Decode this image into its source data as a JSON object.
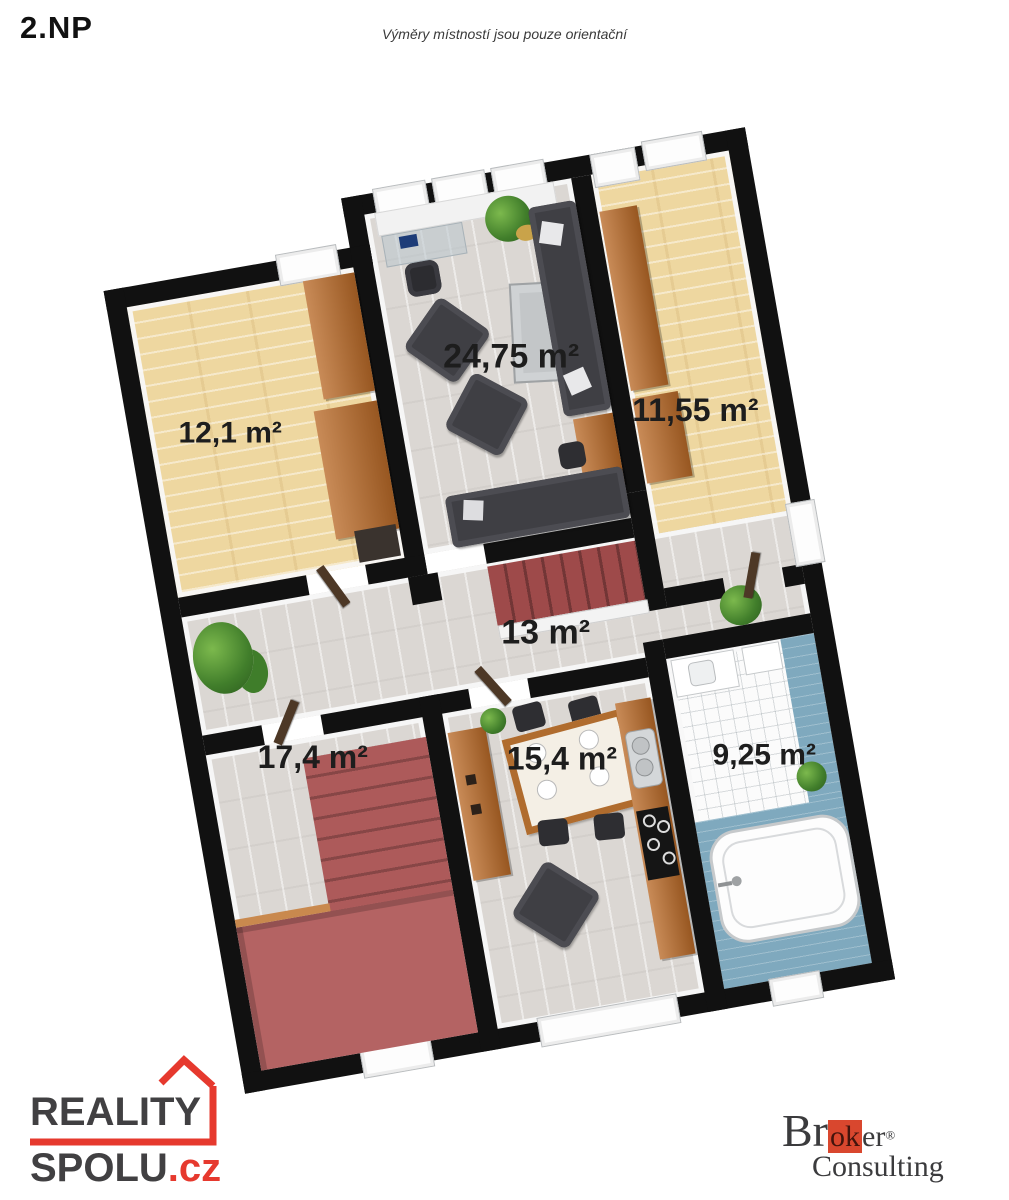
{
  "header": {
    "floor_label": "2.NP",
    "disclaimer": "Výměry místností jsou pouze orientační"
  },
  "plan": {
    "rooms": [
      {
        "name": "bedroom-upper-left",
        "area": "12,1 m²"
      },
      {
        "name": "living-room",
        "area": "24,75 m²"
      },
      {
        "name": "bedroom-upper-right",
        "area": "11,55 m²"
      },
      {
        "name": "hallway",
        "area": "13 m²"
      },
      {
        "name": "room-lower-left",
        "area": "17,4 m²"
      },
      {
        "name": "kitchen-dining",
        "area": "15,4 m²"
      },
      {
        "name": "bathroom",
        "area": "9,25 m²"
      }
    ],
    "colors": {
      "wall": "#111111",
      "pine_floor": "#eed7a0",
      "laminate_floor": "#dbd7d3",
      "wood_furniture": "#b96a28",
      "stairs_red": "#a45151",
      "sofa_gray": "#3f3f44",
      "bathroom_blue": "#7fa9be"
    }
  },
  "branding": {
    "reality_spolu": {
      "word1": "REALITY",
      "word2": "SPOLU",
      "suffix": ".cz",
      "accent_red": "#e6392e",
      "charcoal": "#414042"
    },
    "broker_consulting": {
      "pre": "Br",
      "boxed": "ok",
      "post": "er",
      "registered": "®",
      "second_line": "Consulting",
      "box_red": "#d9472e",
      "ink": "#3b3b3d"
    }
  }
}
